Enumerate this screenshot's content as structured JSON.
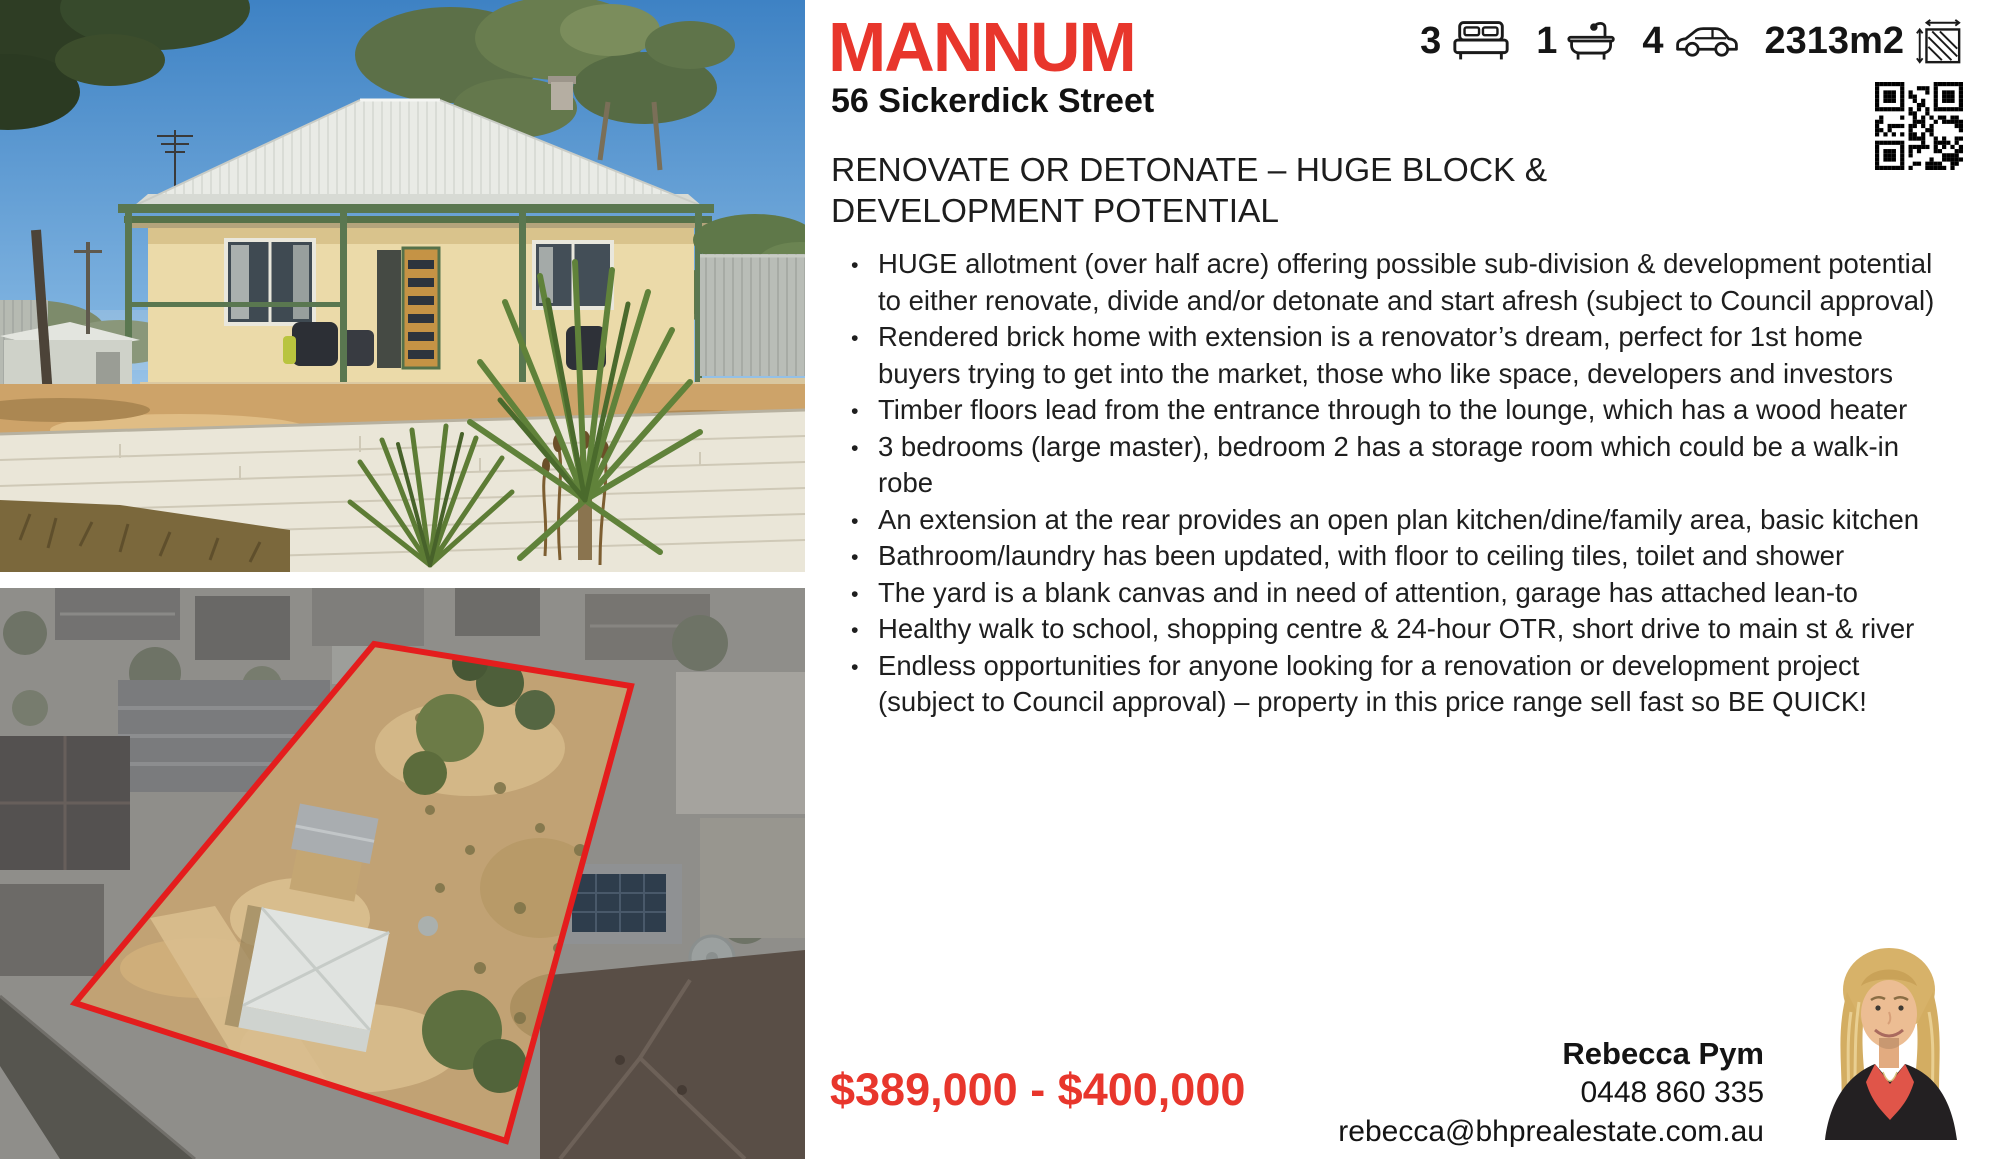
{
  "brand": {
    "suburb": "MANNUM",
    "address": "56 Sickerdick Street"
  },
  "stats": {
    "beds": "3",
    "baths": "1",
    "cars": "4",
    "land_size": "2313m2"
  },
  "headline": "RENOVATE OR DETONATE – HUGE BLOCK & DEVELOPMENT POTENTIAL",
  "bullets": [
    "HUGE allotment (over half acre) offering possible sub-division & development potential to either renovate, divide and/or detonate and start afresh (subject to Council approval)",
    "Rendered brick home with extension is a renovator’s dream, perfect for 1st home buyers trying to get into the market, those who like space, developers and investors",
    "Timber floors lead from the entrance through to the lounge, which has a wood heater",
    "3 bedrooms (large master), bedroom 2 has a storage room which could be a walk-in robe",
    "An extension at the rear provides an open plan kitchen/dine/family area, basic kitchen",
    "Bathroom/laundry has been updated, with floor to ceiling tiles, toilet and shower",
    "The yard is a blank canvas and in need of attention, garage has attached lean-to",
    "Healthy walk to school, shopping centre & 24-hour OTR, short drive to main st & river",
    "Endless opportunities for anyone looking for a renovation or development project (subject to Council approval) – property in this price range sell fast so BE QUICK!"
  ],
  "price": "$389,000 - $400,000",
  "agent": {
    "name": "Rebecca Pym",
    "phone": "0448 860 335",
    "email": "rebecca@bhprealestate.com.au"
  },
  "colors": {
    "accent_red": "#e8362c",
    "boundary_red": "#e41d1d"
  }
}
